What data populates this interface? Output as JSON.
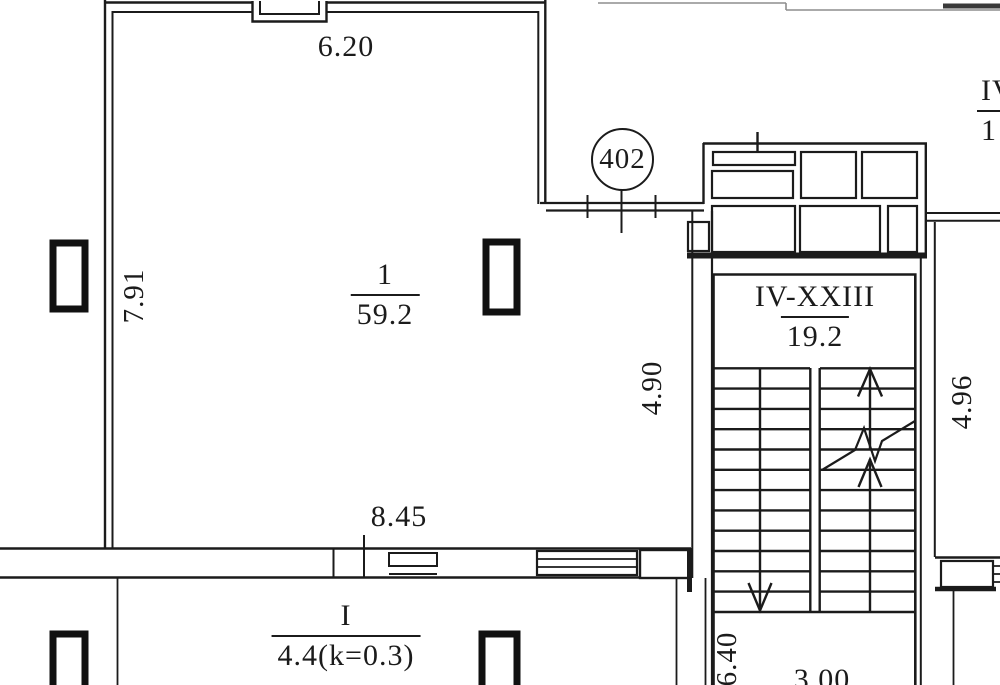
{
  "plan": {
    "unit_badge": "402",
    "rooms": [
      {
        "id": "room-1",
        "number": "1",
        "area": "59.2"
      },
      {
        "id": "stairwell",
        "number": "IV-XXIII",
        "area": "19.2"
      },
      {
        "id": "room-i",
        "number": "I",
        "area": "4.4(k=0.3)"
      },
      {
        "id": "adjacent-unit",
        "number": "IV",
        "area": "1"
      }
    ],
    "dimensions": {
      "top_width": "6.20",
      "left_height": "7.91",
      "room1_inner_height": "4.90",
      "stair_right_height": "4.96",
      "bottom_width": "8.45",
      "stair_bottom_height": "6.40",
      "landing_width": "3.00"
    },
    "colors": {
      "line": "#1b1b1b",
      "background": "#ffffff"
    }
  }
}
